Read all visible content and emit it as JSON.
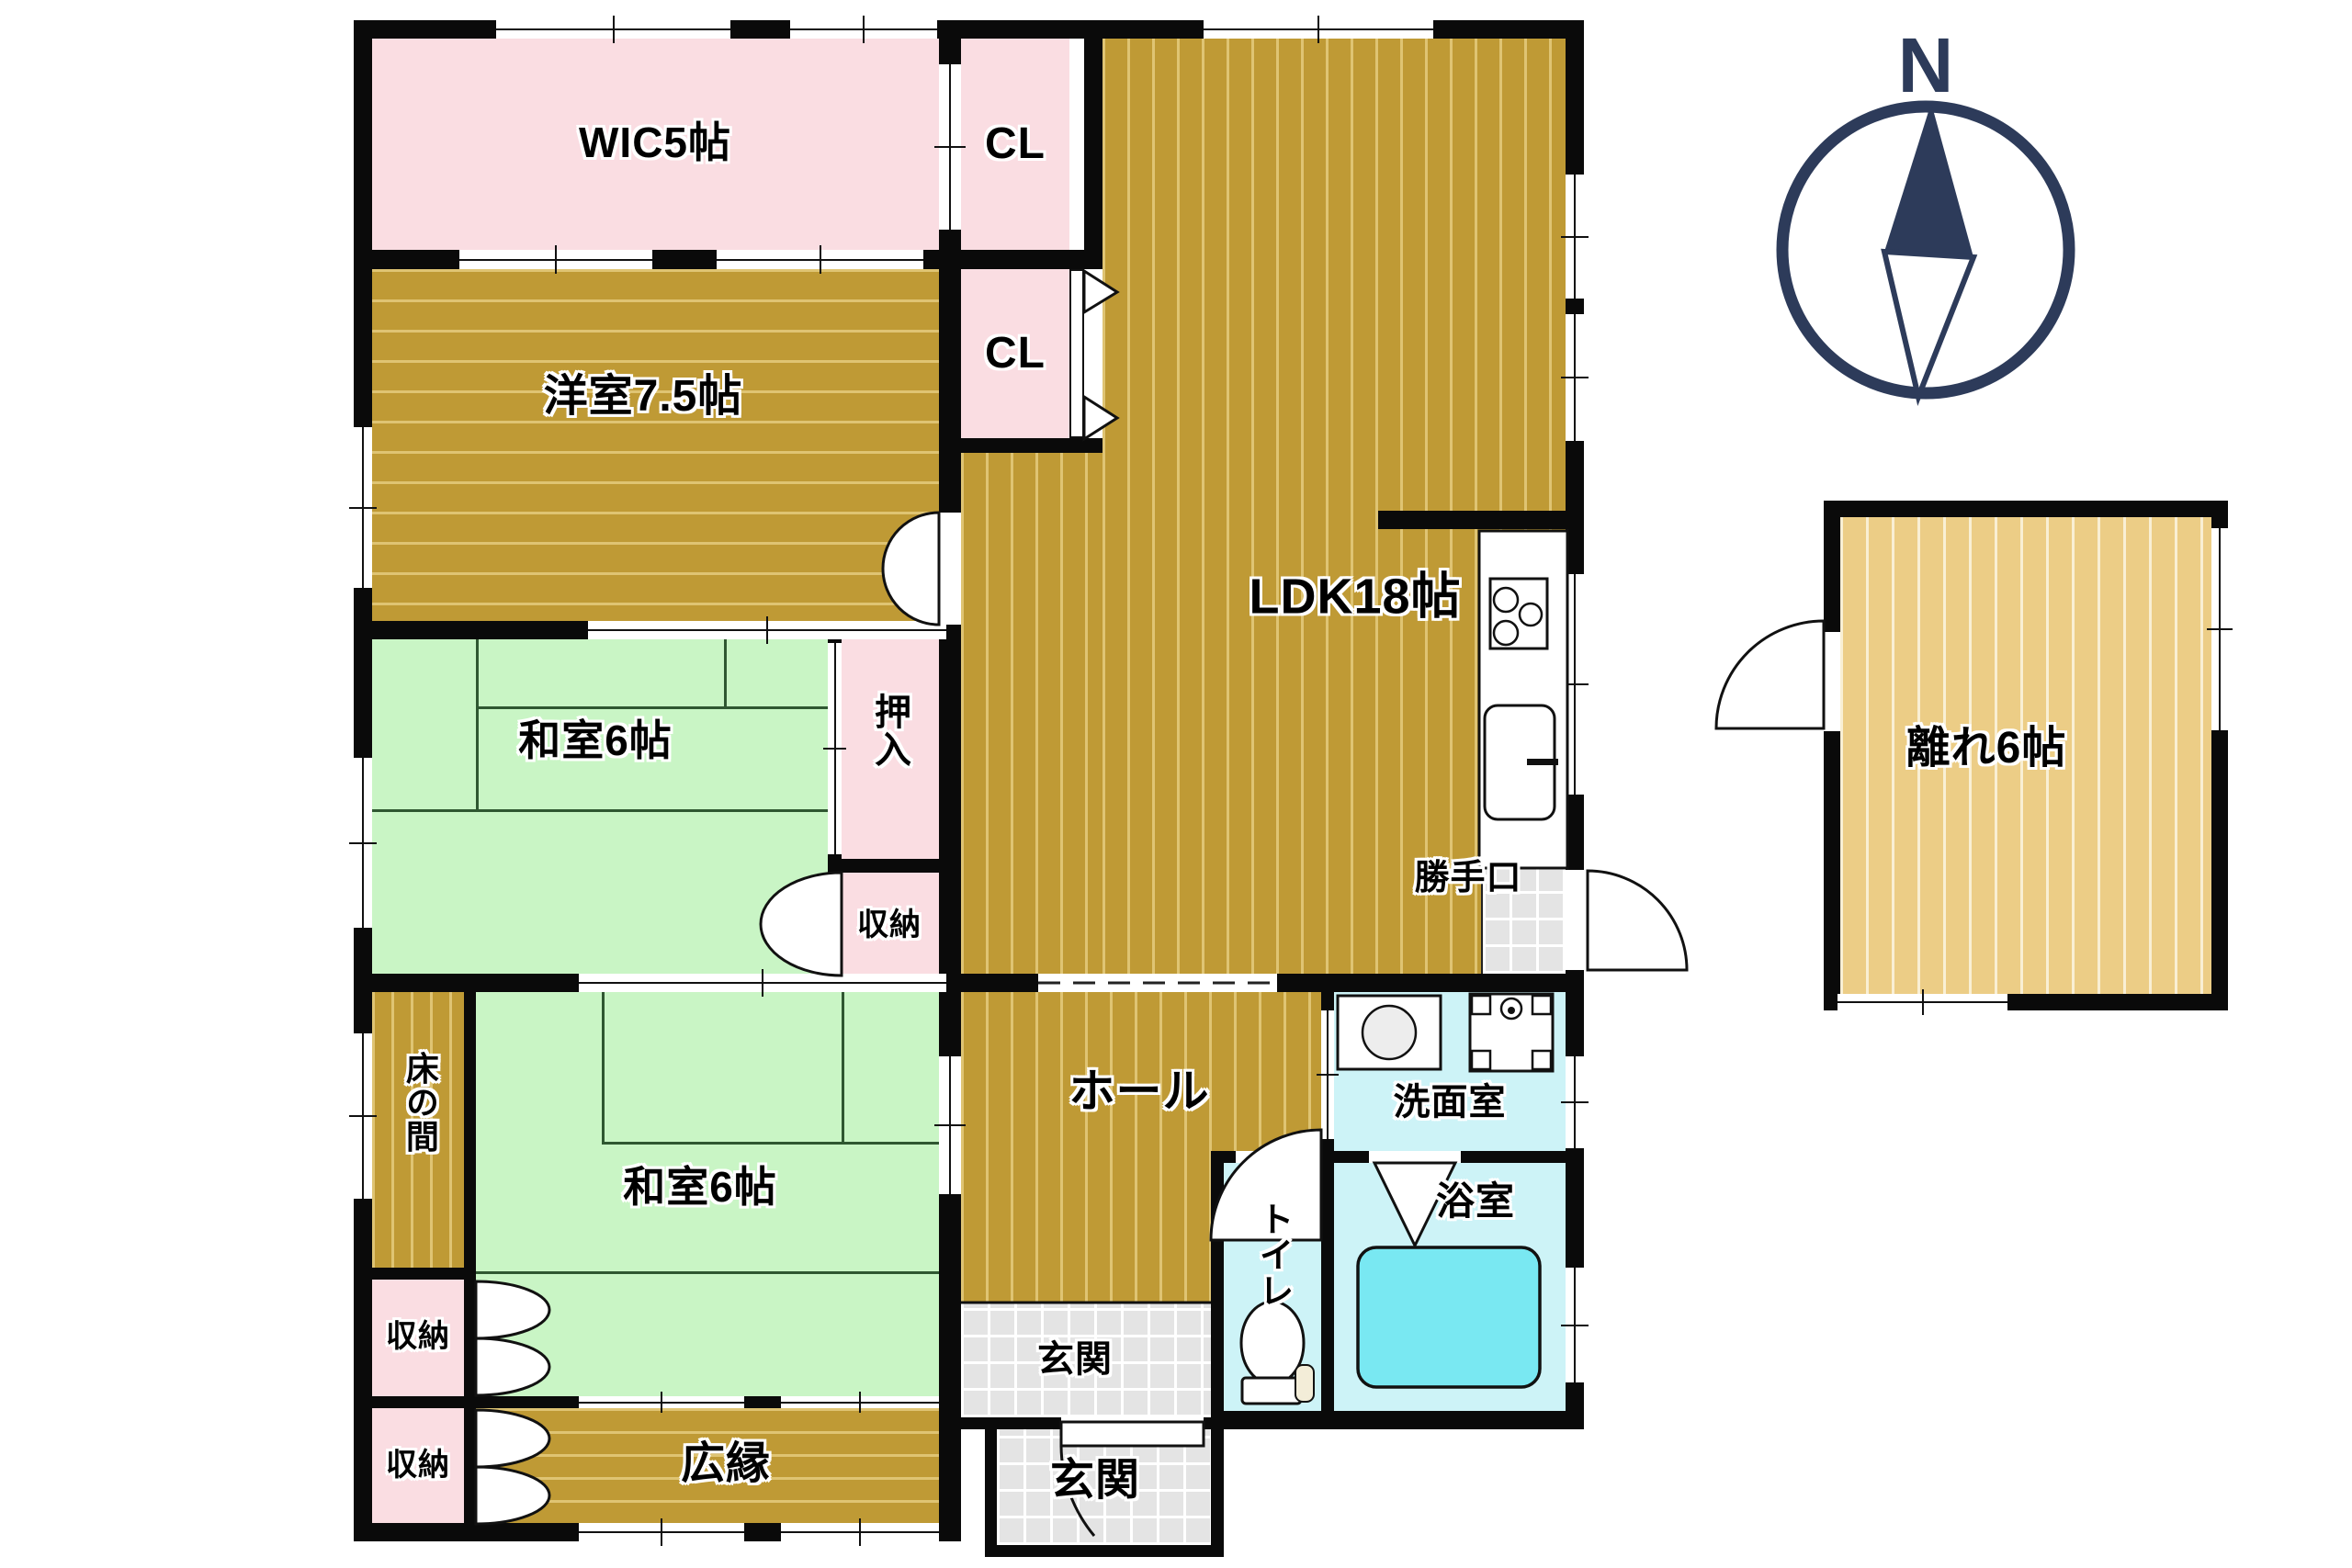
{
  "colors": {
    "wall": "#0a0a0a",
    "pink": "#fadde2",
    "gold": "#bf9a35",
    "gold-stripe": "#dfc473",
    "tatami": "#c9f5c5",
    "tatami-line": "#2f5731",
    "light-gold": "#eccd86",
    "light-gold-stripe": "#f9efd4",
    "cyan": "#cdf3f7",
    "tub": "#79e8f2",
    "tile": "#e4e4e4",
    "navy": "#2d3b5a",
    "label": "#000000"
  },
  "rooms": {
    "wic": {
      "label": "WIC5帖"
    },
    "cl_top": {
      "label": "CL"
    },
    "cl_mid": {
      "label": "CL"
    },
    "youshitsu": {
      "label": "洋室7.5帖"
    },
    "ldk": {
      "label": "LDK18帖"
    },
    "oshiire": {
      "label": "押入"
    },
    "washitsu_upper": {
      "label": "和室6帖"
    },
    "shunou_upper": {
      "label": "収納"
    },
    "tokonoma": {
      "label": "床の間"
    },
    "washitsu_lower": {
      "label": "和室6帖"
    },
    "shunou_left_upper": {
      "label": "収納"
    },
    "shunou_left_lower": {
      "label": "収納"
    },
    "hiroen": {
      "label": "広縁"
    },
    "hall": {
      "label": "ホール"
    },
    "katteguchi": {
      "label": "勝手口"
    },
    "senmenshitsu": {
      "label": "洗面室"
    },
    "toire": {
      "label": "トイレ"
    },
    "yokushitsu": {
      "label": "浴室"
    },
    "genkan_inner": {
      "label": "玄関"
    },
    "genkan_outer": {
      "label": "玄関"
    },
    "hanare": {
      "label": "離れ6帖"
    }
  },
  "compass": {
    "north_label": "N"
  }
}
